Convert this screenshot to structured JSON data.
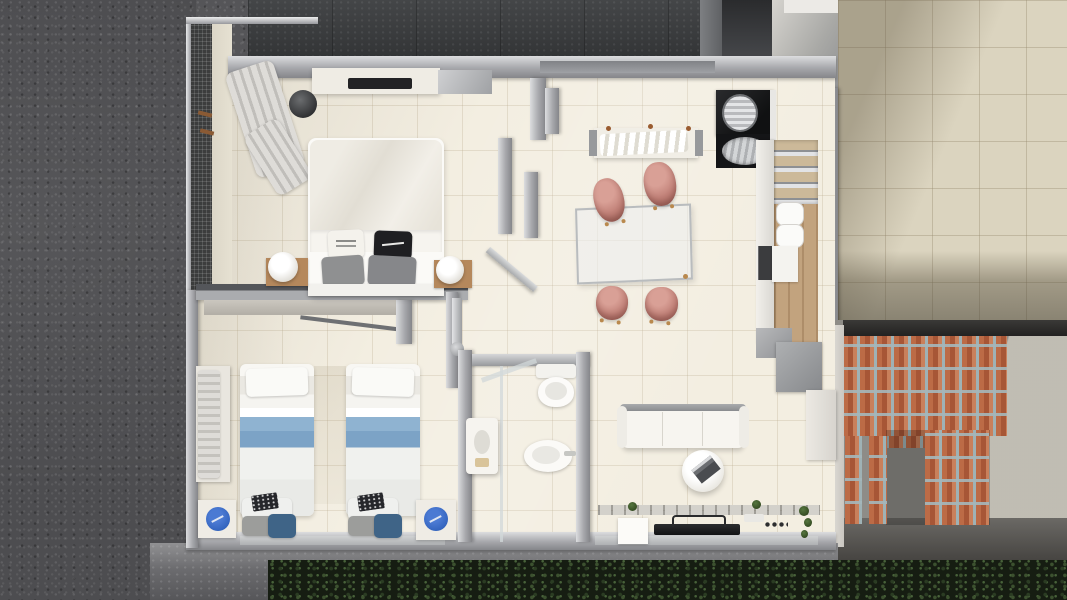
{
  "scene": {
    "description": "Top-down 3D architectural render of a furnished small apartment beside a road, with a tiled terrace and a red-brick entry screen",
    "view": "top-down floor-plan render, no visible text",
    "exterior": {
      "road_surface": "dark speckled asphalt",
      "upper_boundary": "dark concrete wall band",
      "pavement": "grey kerb / gravel strip along the bottom",
      "roadside_hedge": "dark green shrubs along the bottom edge",
      "terrace": "empty beige ceramic-tile terrace with diagonal building shadow (top right)",
      "entry_porch": "vertical red-brick slat screen with three brick pillars over dark concrete (bottom right)"
    },
    "rooms": [
      {
        "id": "master-bedroom",
        "position": "top-left",
        "furniture": [
          "balcony with dark mesh railing",
          "open clothes rack with hanging garments",
          "round dark laundry basket",
          "wall shelf with black TV soundbar",
          "double bed with white duvet",
          "white lettered pillow",
          "black lettered pillow",
          "two grey cushions",
          "left wooden nightstand with round white lamp",
          "right wooden nightstand with round white lamp",
          "open door to hallway"
        ]
      },
      {
        "id": "twin-bedroom",
        "position": "bottom-left",
        "furniture": [
          "wardrobe with hanging clothes",
          "left single bed with blue striped bedding",
          "right single bed with blue striped bedding",
          "stacked grey and blue pillows with dark book at each bed foot",
          "left white nightstand with blue round tray",
          "right white nightstand with blue round tray",
          "grey wall desk shelf"
        ]
      },
      {
        "id": "bathroom",
        "position": "bottom-center",
        "fixtures": [
          "steel shower column",
          "glass partition",
          "white wall washbasin unit",
          "toilet with cistern",
          "bidet"
        ]
      },
      {
        "id": "dining-area",
        "position": "center",
        "furniture": [
          "glass dining table",
          "salmon pink shell chair x4",
          "console desk with rumpled white cloth"
        ]
      },
      {
        "id": "kitchen-strip",
        "position": "right",
        "fixtures": [
          "black counter with steel water-heater cylinder",
          "round steel sink with drainer",
          "four timber steps",
          "tall white counter",
          "two white canisters",
          "built-in dark oven",
          "white cabinet block",
          "timber floor strip",
          "grey storage cabinets",
          "white utility column"
        ]
      },
      {
        "id": "living-area",
        "position": "bottom-right",
        "furniture": [
          "white three-seat sofa",
          "round white coffee table with dark magazine",
          "window sill with small plants",
          "white low cabinet",
          "wall-mounted flat TV seen edge-on",
          "row of four black knobs",
          "trailing green plant"
        ]
      }
    ],
    "palette": {
      "asphalt": "#4d4d50",
      "concrete_band": "#3a3c3e",
      "interior_floor": "#f3eee1",
      "terrace_tile": "#dbd4bf",
      "wall_metal": "#a6a7ab",
      "chair_salmon": "#c08077",
      "bed_stripe_blue": "#7ca3c6",
      "tray_blue": "#3263bd",
      "brick": "#b3613f",
      "hedge_green": "#161d12",
      "wood": "#b5885c"
    },
    "counts": {
      "dining_chairs": 4,
      "single_beds": 2,
      "double_beds": 1,
      "round_lamps": 2,
      "brick_pillars": 3
    }
  }
}
